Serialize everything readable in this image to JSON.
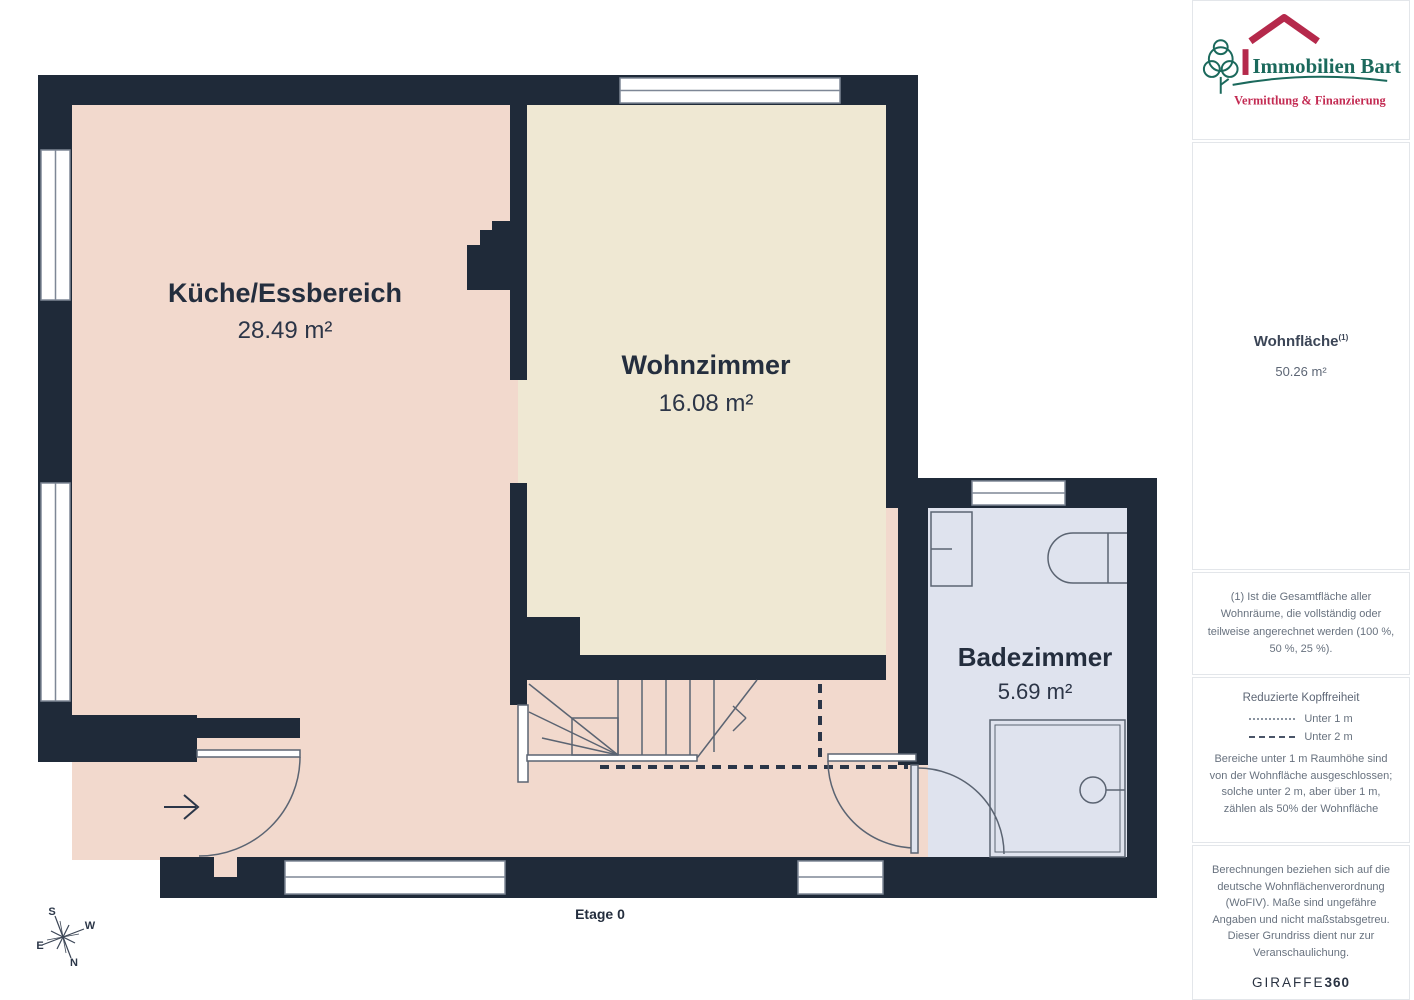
{
  "plan": {
    "rooms": [
      {
        "name": "Küche/Essbereich",
        "area": "28.49 m²"
      },
      {
        "name": "Wohnzimmer",
        "area": "16.08 m²"
      },
      {
        "name": "Badezimmer",
        "area": "5.69 m²"
      }
    ],
    "floor_label": "Etage 0",
    "compass": {
      "n": "N",
      "s": "S",
      "e": "E",
      "w": "W"
    }
  },
  "sidebar": {
    "logo": {
      "title": "Immobilien Bart",
      "subtitle": "Vermittlung & Finanzierung"
    },
    "area_summary": {
      "label": "Wohnfläche",
      "superscript": "(1)",
      "value": "50.26 m²"
    },
    "footnote": "(1) Ist die Gesamtfläche aller Wohnräume, die vollständig oder teilweise angerechnet werden (100 %, 50 %, 25 %).",
    "headroom": {
      "title": "Reduzierte Kopffreiheit",
      "legend": [
        {
          "style": "dotted",
          "label": "Unter 1 m"
        },
        {
          "style": "dashed",
          "label": "Unter 2 m"
        }
      ],
      "note": "Bereiche unter 1 m Raumhöhe sind von der Wohnfläche ausgeschlossen; solche unter 2 m, aber über 1 m, zählen als 50% der Wohnfläche"
    },
    "disclaimer": "Berechnungen beziehen sich auf die deutsche Wohnflächenverordnung (WoFIV). Maße sind ungefähre Angaben und nicht maßstabsgetreu. Dieser Grundriss dient nur zur Veranschaulichung.",
    "brand": {
      "giraffe": "GIRAFFE",
      "num": "360"
    }
  },
  "colors": {
    "wall": "#1f2a39",
    "kitchen_fill": "#f2d9cd",
    "living_fill": "#efe8d3",
    "bathroom_fill": "#dfe3ee",
    "logo_green": "#1b695c",
    "logo_red": "#b5294b",
    "subtitle_red": "#c32a52"
  }
}
